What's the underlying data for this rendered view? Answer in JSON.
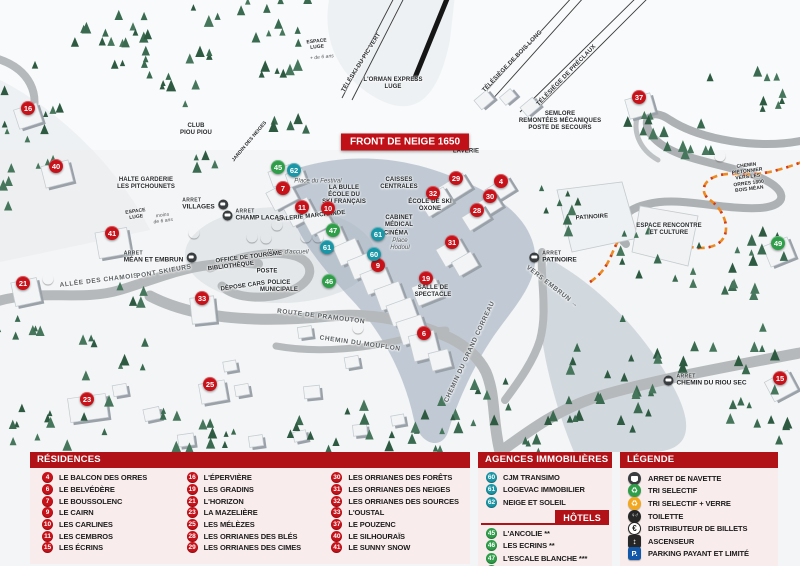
{
  "map": {
    "banner": "FRONT DE NEIGE 1650",
    "stop_prefix": "ARRET",
    "markers": [
      {
        "n": "16",
        "cls": "res",
        "x": 28,
        "y": 108
      },
      {
        "n": "40",
        "cls": "res",
        "x": 56,
        "y": 166
      },
      {
        "n": "41",
        "cls": "res",
        "x": 112,
        "y": 233
      },
      {
        "n": "21",
        "cls": "res",
        "x": 23,
        "y": 283
      },
      {
        "n": "33",
        "cls": "res",
        "x": 202,
        "y": 298
      },
      {
        "n": "23",
        "cls": "res",
        "x": 87,
        "y": 399
      },
      {
        "n": "25",
        "cls": "res",
        "x": 210,
        "y": 384
      },
      {
        "n": "7",
        "cls": "res",
        "x": 283,
        "y": 188
      },
      {
        "n": "11",
        "cls": "res",
        "x": 302,
        "y": 207
      },
      {
        "n": "10",
        "cls": "res",
        "x": 328,
        "y": 208
      },
      {
        "n": "9",
        "cls": "res",
        "x": 378,
        "y": 265
      },
      {
        "n": "19",
        "cls": "res",
        "x": 426,
        "y": 278
      },
      {
        "n": "6",
        "cls": "res",
        "x": 424,
        "y": 333
      },
      {
        "n": "29",
        "cls": "res",
        "x": 456,
        "y": 178
      },
      {
        "n": "4",
        "cls": "res",
        "x": 501,
        "y": 181
      },
      {
        "n": "32",
        "cls": "res",
        "x": 433,
        "y": 193
      },
      {
        "n": "30",
        "cls": "res",
        "x": 490,
        "y": 196
      },
      {
        "n": "28",
        "cls": "res",
        "x": 477,
        "y": 210
      },
      {
        "n": "31",
        "cls": "res",
        "x": 452,
        "y": 242
      },
      {
        "n": "37",
        "cls": "res",
        "x": 639,
        "y": 97
      },
      {
        "n": "15",
        "cls": "res",
        "x": 780,
        "y": 378
      },
      {
        "n": "45",
        "cls": "hotel",
        "x": 278,
        "y": 167
      },
      {
        "n": "47",
        "cls": "hotel",
        "x": 333,
        "y": 230
      },
      {
        "n": "46",
        "cls": "hotel",
        "x": 329,
        "y": 281
      },
      {
        "n": "49",
        "cls": "hotel",
        "x": 778,
        "y": 243
      },
      {
        "n": "62",
        "cls": "agency",
        "x": 294,
        "y": 170
      },
      {
        "n": "61",
        "cls": "agency",
        "x": 378,
        "y": 234
      },
      {
        "n": "61",
        "cls": "agency",
        "x": 327,
        "y": 247
      },
      {
        "n": "60",
        "cls": "agency",
        "x": 374,
        "y": 254
      }
    ],
    "icons": [
      {
        "icon": "recycle-green-icon",
        "x": 194,
        "y": 233
      },
      {
        "icon": "recycle-green-icon",
        "x": 48,
        "y": 279
      },
      {
        "icon": "recycle-green-icon",
        "x": 358,
        "y": 328
      },
      {
        "icon": "recycle-green-icon",
        "x": 720,
        "y": 156
      },
      {
        "icon": "recycle-yellow-icon",
        "x": 252,
        "y": 237
      },
      {
        "icon": "parking-icon",
        "x": 266,
        "y": 238
      },
      {
        "icon": "atm-icon",
        "x": 277,
        "y": 225
      },
      {
        "icon": "toilet-icon",
        "x": 306,
        "y": 237
      },
      {
        "icon": "elevator-icon",
        "x": 318,
        "y": 237
      }
    ],
    "stops": [
      {
        "label": "VILLAGES",
        "x": 205,
        "y": 204,
        "side": "right"
      },
      {
        "label": "CHAMP LACAS",
        "x": 253,
        "y": 215,
        "side": "left"
      },
      {
        "label": "MÉAN ET EMBRUN",
        "x": 160,
        "y": 257,
        "side": "right"
      },
      {
        "label": "PATINOIRE",
        "x": 553,
        "y": 257,
        "side": "left"
      },
      {
        "label": "CHEMIN DU RIOU SEC",
        "x": 705,
        "y": 380,
        "side": "left"
      }
    ],
    "labels": [
      {
        "text": "TÉLÉSKI DU PIC VERT",
        "x": 362,
        "y": 63,
        "cls": "lift",
        "rot": -58
      },
      {
        "text": "L'ORMAN EXPRESS\nLUGE",
        "x": 393,
        "y": 84,
        "cls": "small"
      },
      {
        "text": "TÉLÉSIÈGE DE BOIS LONG",
        "x": 513,
        "y": 62,
        "cls": "lift",
        "rot": -46
      },
      {
        "text": "TÉLÉSIÈGE DE PRÉCLAUX",
        "x": 567,
        "y": 76,
        "cls": "lift",
        "rot": -46
      },
      {
        "text": "SEMLORE\nREMONTÉES MÉCANIQUES\nPOSTE DE SECOURS",
        "x": 560,
        "y": 122,
        "cls": "small"
      },
      {
        "text": "ESPACE\nLUGE",
        "x": 317,
        "y": 45,
        "cls": "tiny",
        "rot": -6
      },
      {
        "text": "+ de 6 ans",
        "x": 322,
        "y": 58,
        "cls": "tiny italic",
        "rot": -6
      },
      {
        "text": "CLUB\nPIOU PIOU",
        "x": 196,
        "y": 130,
        "cls": "small"
      },
      {
        "text": "JARDIN DES NEIGES",
        "x": 250,
        "y": 142,
        "cls": "tiny",
        "rot": -50
      },
      {
        "text": "HALTE GARDERIE\nLES PITCHOUNETS",
        "x": 146,
        "y": 184,
        "cls": "small"
      },
      {
        "text": "ESPACE\nLUGE",
        "x": 136,
        "y": 215,
        "cls": "tiny",
        "rot": -8
      },
      {
        "text": "moins\nde 6 ans",
        "x": 163,
        "y": 219,
        "cls": "tiny italic",
        "rot": -8
      },
      {
        "text": "LAVERIE",
        "x": 466,
        "y": 152,
        "cls": "small"
      },
      {
        "text": "CAISSES\nCENTRALES",
        "x": 399,
        "y": 184,
        "cls": "small"
      },
      {
        "text": "LA BULLE\nÉCOLE DU\nSKI FRANÇAIS",
        "x": 344,
        "y": 196,
        "cls": "small"
      },
      {
        "text": "Place du Festival",
        "x": 318,
        "y": 182,
        "cls": "italic"
      },
      {
        "text": "GALERIE MARCHANDE",
        "x": 311,
        "y": 217,
        "cls": "small",
        "rot": -6
      },
      {
        "text": "ÉCOLE DE SKI\nOXONE",
        "x": 430,
        "y": 206,
        "cls": "small"
      },
      {
        "text": "CABINET\nMÉDICAL",
        "x": 399,
        "y": 222,
        "cls": "small"
      },
      {
        "text": "CINÉMA",
        "x": 396,
        "y": 234,
        "cls": "small"
      },
      {
        "text": "Place\nHodoul",
        "x": 400,
        "y": 245,
        "cls": "italic"
      },
      {
        "text": "Place d'accueil",
        "x": 288,
        "y": 253,
        "cls": "italic"
      },
      {
        "text": "OFFICE DE TOURISME",
        "x": 249,
        "y": 258,
        "cls": "small",
        "rot": -7
      },
      {
        "text": "BIBLIOTHÈQUE",
        "x": 231,
        "y": 267,
        "cls": "small",
        "rot": -7
      },
      {
        "text": "POSTE",
        "x": 267,
        "y": 272,
        "cls": "small"
      },
      {
        "text": "DÉPOSE CARS",
        "x": 243,
        "y": 287,
        "cls": "small",
        "rot": -8
      },
      {
        "text": "POLICE\nMUNICIPALE",
        "x": 279,
        "y": 287,
        "cls": "small"
      },
      {
        "text": "ALLÉE DES CHAMOIS",
        "x": 99,
        "y": 281,
        "cls": "road",
        "rot": -7
      },
      {
        "text": "PONT SKIEURS",
        "x": 164,
        "y": 272,
        "cls": "road",
        "rot": -10
      },
      {
        "text": "ROUTE DE PRAMOUTON",
        "x": 321,
        "y": 317,
        "cls": "road",
        "rot": 7
      },
      {
        "text": "CHEMIN DU MOUFLON",
        "x": 360,
        "y": 344,
        "cls": "road",
        "rot": 8
      },
      {
        "text": "CHEMIN DU GRAND CORREAU",
        "x": 470,
        "y": 352,
        "cls": "road",
        "rot": -65
      },
      {
        "text": "SALLE DE\nSPECTACLE",
        "x": 433,
        "y": 292,
        "cls": "small"
      },
      {
        "text": "VERS EMBRUN →",
        "x": 552,
        "y": 287,
        "cls": "road",
        "rot": 38
      },
      {
        "text": "PATINOIRE",
        "x": 592,
        "y": 218,
        "cls": "small",
        "rot": -4
      },
      {
        "text": "ESPACE RENCONTRE\nET CULTURE",
        "x": 669,
        "y": 230,
        "cls": "small"
      },
      {
        "text": "CHEMIN PIÉTONNIER\nVERS LES ORRES 1800\nBOIS MÉAN",
        "x": 748,
        "y": 178,
        "cls": "tiny",
        "rot": -7
      }
    ]
  },
  "legend": {
    "residences": {
      "title": "RÉSIDENCES",
      "col1": [
        {
          "n": "4",
          "label": "LE BALCON DES ORRES"
        },
        {
          "n": "6",
          "label": "LE BELVÉDÈRE"
        },
        {
          "n": "7",
          "label": "LE BOUSSOLENC"
        },
        {
          "n": "9",
          "label": "LE CAIRN"
        },
        {
          "n": "10",
          "label": "LES CARLINES"
        },
        {
          "n": "11",
          "label": "LES CEMBROS"
        },
        {
          "n": "15",
          "label": "LES ÉCRINS"
        }
      ],
      "col2": [
        {
          "n": "16",
          "label": "L'ÉPERVIÈRE"
        },
        {
          "n": "19",
          "label": "LES GRADINS"
        },
        {
          "n": "21",
          "label": "L'HORIZON"
        },
        {
          "n": "23",
          "label": "LA MAZELIÈRE"
        },
        {
          "n": "25",
          "label": "LES MÉLÈZES"
        },
        {
          "n": "28",
          "label": "LES ORRIANES DES BLÉS"
        },
        {
          "n": "29",
          "label": "LES ORRIANES DES CIMES"
        }
      ],
      "col3": [
        {
          "n": "30",
          "label": "LES ORRIANES DES FORÊTS"
        },
        {
          "n": "31",
          "label": "LES ORRIANES DES NEIGES"
        },
        {
          "n": "32",
          "label": "LES ORRIANES DES SOURCES"
        },
        {
          "n": "33",
          "label": "L'OUSTAL"
        },
        {
          "n": "37",
          "label": "LE POUZENC"
        },
        {
          "n": "40",
          "label": "LE SILHOURAÏS"
        },
        {
          "n": "41",
          "label": "LE SUNNY SNOW"
        }
      ]
    },
    "agences": {
      "title": "AGENCES IMMOBILIÈRES",
      "items": [
        {
          "n": "60",
          "label": "CJM TRANSIMO"
        },
        {
          "n": "61",
          "label": "LOGEVAC IMMOBILIER"
        },
        {
          "n": "62",
          "label": "NEIGE ET SOLEIL"
        }
      ]
    },
    "hotels": {
      "title": "HÔTELS",
      "items": [
        {
          "n": "45",
          "label": "L'ANCOLIE **"
        },
        {
          "n": "46",
          "label": "LES ECRINS **"
        },
        {
          "n": "47",
          "label": "L'ESCALE BLANCHE ***"
        },
        {
          "n": "49",
          "label": "LES TRAPPEURS **"
        }
      ]
    },
    "legende": {
      "title": "LÉGENDE",
      "items": [
        {
          "icon": "bus-icon",
          "label": "ARRET DE NAVETTE"
        },
        {
          "icon": "recycle-green-icon",
          "label": "TRI SELECTIF"
        },
        {
          "icon": "recycle-yellow-icon",
          "label": "TRI SELECTIF + VERRE"
        },
        {
          "icon": "toilet-icon",
          "label": "TOILETTE"
        },
        {
          "icon": "atm-icon",
          "label": "DISTRIBUTEUR DE BILLETS"
        },
        {
          "icon": "elevator-icon",
          "label": "ASCENSEUR"
        },
        {
          "icon": "parking-icon",
          "label": "PARKING PAYANT ET LIMITÉ"
        }
      ]
    }
  },
  "colors": {
    "header_red": "#b01218",
    "marker_red": "#c8121a",
    "marker_teal": "#1b96a6",
    "marker_green": "#2f9e49",
    "panel_pink": "#f8ebeb",
    "path_orange": "#ee8a20"
  }
}
